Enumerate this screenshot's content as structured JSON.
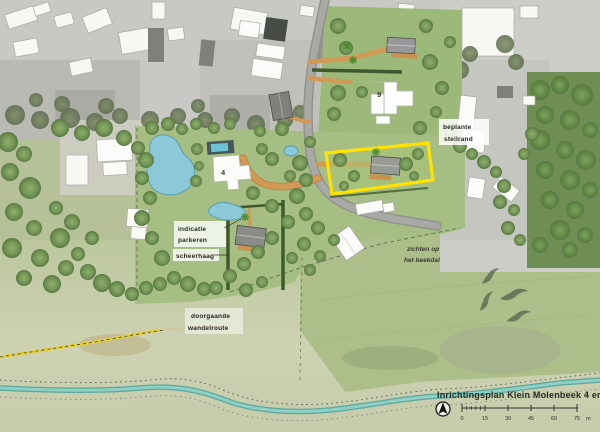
{
  "map": {
    "title": "Inrichtingsplan Klein Molenbeek 4 en 9",
    "labels": {
      "parking_line1": "indicatie",
      "parking_line2": "parkeren",
      "hedge": "scheerhaag",
      "route_line1": "doorgaande",
      "route_line2": "wandelroute",
      "view_line1": "zichten op",
      "view_line2": "het beekdal",
      "escarpment_line1": "beplante",
      "escarpment_line2": "steilrand",
      "house_number_9": "9",
      "house_number_4": "4"
    },
    "scale_bar": {
      "ticks": [
        "0",
        "15",
        "30",
        "45",
        "60",
        "75"
      ],
      "unit": "m"
    },
    "legend_colors": {
      "parcel_highlight": "#ffe200",
      "path_orange": "#d09a56",
      "water": "#7cc4ba",
      "lawn": "#a6be83"
    }
  }
}
